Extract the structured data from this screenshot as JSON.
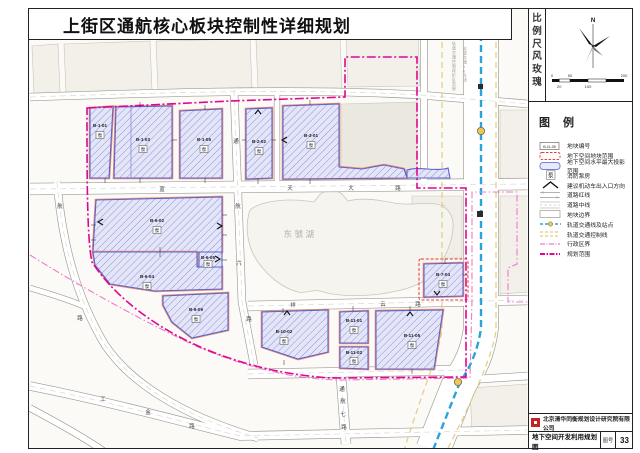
{
  "title": "上街区通航核心板块控制性详细规划",
  "sidebar": {
    "scale_rose_label": "比例尺风玫瑰",
    "north_label": "N",
    "scale_ticks_top": [
      "0",
      "50",
      "200"
    ],
    "scale_ticks_bottom": [
      "20",
      "100"
    ],
    "legend_title": "图例",
    "legend": [
      {
        "label": "地块编号",
        "swatch": "block-id-badge",
        "swatch_text": "B-11-05"
      },
      {
        "label": "地下空间地块范围",
        "swatch": "red-dashed-rect"
      },
      {
        "label": "地下空间水平最大投影范围",
        "swatch": "blue-rounded-rect"
      },
      {
        "label": "消防泵房",
        "swatch": "pump-box",
        "swatch_text": "泵"
      },
      {
        "label": "建议机动车出入口方向",
        "swatch": "arrow"
      },
      {
        "label": "道路红线",
        "swatch": "road-redline"
      },
      {
        "label": "道路中线",
        "swatch": "road-centerline"
      },
      {
        "label": "地块边界",
        "swatch": "parcel-boundary"
      },
      {
        "label": "轨道交通线及站点",
        "swatch": "rail-line-station"
      },
      {
        "label": "轨道交通控制线",
        "swatch": "rail-control-line"
      },
      {
        "label": "行政区界",
        "swatch": "admin-boundary"
      },
      {
        "label": "规划范围",
        "swatch": "planning-scope"
      }
    ],
    "company": "北京清华同衡规划设计研究院有限公司",
    "drawing_title": "地下空间开发利用规划图",
    "sheet_label": "图号",
    "sheet_number": "33"
  },
  "map": {
    "lake_label": "东虢湖",
    "labels": [
      {
        "t": "B-1-01",
        "x": 100,
        "y": 127,
        "c": "blk",
        "n": "block-label"
      },
      {
        "t": "泵",
        "x": 100,
        "y": 137,
        "c": "pump",
        "n": "pump-label"
      },
      {
        "t": "B-1-03",
        "x": 143,
        "y": 141,
        "c": "blk",
        "n": "block-label"
      },
      {
        "t": "泵",
        "x": 143,
        "y": 151,
        "c": "pump",
        "n": "pump-label"
      },
      {
        "t": "B-1-05",
        "x": 204,
        "y": 141,
        "c": "blk",
        "n": "block-label"
      },
      {
        "t": "泵",
        "x": 204,
        "y": 151,
        "c": "pump",
        "n": "pump-label"
      },
      {
        "t": "B-2-02",
        "x": 259,
        "y": 143,
        "c": "blk",
        "n": "block-label"
      },
      {
        "t": "泵",
        "x": 259,
        "y": 153,
        "c": "pump",
        "n": "pump-label"
      },
      {
        "t": "B-3-01",
        "x": 311,
        "y": 137,
        "c": "blk",
        "n": "block-label"
      },
      {
        "t": "泵",
        "x": 311,
        "y": 147,
        "c": "pump",
        "n": "pump-label"
      },
      {
        "t": "B-6-02",
        "x": 157,
        "y": 222,
        "c": "blk",
        "n": "block-label"
      },
      {
        "t": "泵",
        "x": 157,
        "y": 232,
        "c": "pump",
        "n": "pump-label"
      },
      {
        "t": "B-6-04",
        "x": 147,
        "y": 278,
        "c": "blk",
        "n": "block-label"
      },
      {
        "t": "泵",
        "x": 147,
        "y": 288,
        "c": "pump",
        "n": "pump-label"
      },
      {
        "t": "B-6-05",
        "x": 208,
        "y": 259,
        "c": "blk",
        "n": "block-label"
      },
      {
        "t": "泵",
        "x": 208,
        "y": 266,
        "c": "pump",
        "n": "pump-label"
      },
      {
        "t": "B-6-09",
        "x": 196,
        "y": 311,
        "c": "blk",
        "n": "block-label"
      },
      {
        "t": "泵",
        "x": 196,
        "y": 321,
        "c": "pump",
        "n": "pump-label"
      },
      {
        "t": "B-7-04",
        "x": 443,
        "y": 276,
        "c": "blk",
        "n": "block-label"
      },
      {
        "t": "泵",
        "x": 443,
        "y": 286,
        "c": "pump",
        "n": "pump-label"
      },
      {
        "t": "B-10-02",
        "x": 284,
        "y": 333,
        "c": "blk",
        "n": "block-label"
      },
      {
        "t": "泵",
        "x": 284,
        "y": 343,
        "c": "pump",
        "n": "pump-label"
      },
      {
        "t": "B-11-01",
        "x": 354,
        "y": 322,
        "c": "blk",
        "n": "block-label"
      },
      {
        "t": "泵",
        "x": 354,
        "y": 332,
        "c": "pump",
        "n": "pump-label"
      },
      {
        "t": "B-11-02",
        "x": 354,
        "y": 354,
        "c": "blk",
        "n": "block-label"
      },
      {
        "t": "泵",
        "x": 354,
        "y": 363,
        "c": "pump",
        "n": "pump-label"
      },
      {
        "t": "B-11-05",
        "x": 412,
        "y": 337,
        "c": "blk",
        "n": "block-label"
      },
      {
        "t": "泵",
        "x": 412,
        "y": 347,
        "c": "pump",
        "n": "pump-label"
      },
      {
        "t": "蓝",
        "x": 162,
        "y": 191,
        "c": "rd",
        "n": "road-label"
      },
      {
        "t": "天",
        "x": 290,
        "y": 190,
        "c": "rd",
        "n": "road-label"
      },
      {
        "t": "大",
        "x": 351,
        "y": 190,
        "c": "rd",
        "n": "road-label"
      },
      {
        "t": "路",
        "x": 398,
        "y": 190,
        "c": "rd",
        "n": "road-label"
      },
      {
        "t": "祥",
        "x": 293,
        "y": 307,
        "c": "rd",
        "n": "road-label"
      },
      {
        "t": "云",
        "x": 383,
        "y": 306,
        "c": "rd",
        "n": "road-label"
      },
      {
        "t": "路",
        "x": 418,
        "y": 306,
        "c": "rd",
        "n": "road-label"
      },
      {
        "t": "通",
        "x": 236,
        "y": 143,
        "c": "rd",
        "n": "road-label"
      },
      {
        "t": "航",
        "x": 238,
        "y": 208,
        "c": "rd",
        "n": "road-label"
      },
      {
        "t": "六",
        "x": 239,
        "y": 265,
        "c": "rd",
        "n": "road-label"
      },
      {
        "t": "路",
        "x": 249,
        "y": 321,
        "c": "rd",
        "n": "road-label"
      },
      {
        "t": "通",
        "x": 342,
        "y": 391,
        "c": "rd",
        "n": "road-label"
      },
      {
        "t": "航",
        "x": 343,
        "y": 403,
        "c": "rd",
        "n": "road-label"
      },
      {
        "t": "七",
        "x": 343,
        "y": 416,
        "c": "rd",
        "n": "road-label"
      },
      {
        "t": "路",
        "x": 344,
        "y": 429,
        "c": "rd",
        "n": "road-label"
      },
      {
        "t": "工",
        "x": 103,
        "y": 401,
        "c": "rd",
        "n": "road-label"
      },
      {
        "t": "金",
        "x": 148,
        "y": 414,
        "c": "rd",
        "n": "road-label"
      },
      {
        "t": "路",
        "x": 192,
        "y": 428,
        "c": "rd",
        "n": "road-label"
      },
      {
        "t": "航",
        "x": 60,
        "y": 208,
        "c": "rd",
        "n": "road-label"
      },
      {
        "t": "路",
        "x": 80,
        "y": 320,
        "c": "rd",
        "n": "road-label"
      },
      {
        "t": "东虢湖",
        "x": 300,
        "y": 237,
        "c": "lake",
        "n": "lake-label"
      },
      {
        "t": "轨道交通控制保护区范围",
        "x": 452,
        "y": 45,
        "c": "tiny",
        "v": true,
        "fs": 4,
        "n": "rail-protection-label"
      },
      {
        "t": "轨道交通10号线",
        "x": 463,
        "y": 50,
        "c": "tiny",
        "v": true,
        "fs": 4,
        "n": "rail-line-label"
      }
    ]
  },
  "colors": {
    "rail_blue": "#28a3dc",
    "rail_control_yellow": "#e3cd7d",
    "admin_pink": "#f078cc",
    "planning_magenta": "#e10590",
    "block_border_blue": "#5e63cc",
    "block_fill": "#e4e6f8",
    "underground_red": "#e8392f",
    "redline_orange": "#ef9070",
    "station_yellow": "#f2c84b"
  }
}
